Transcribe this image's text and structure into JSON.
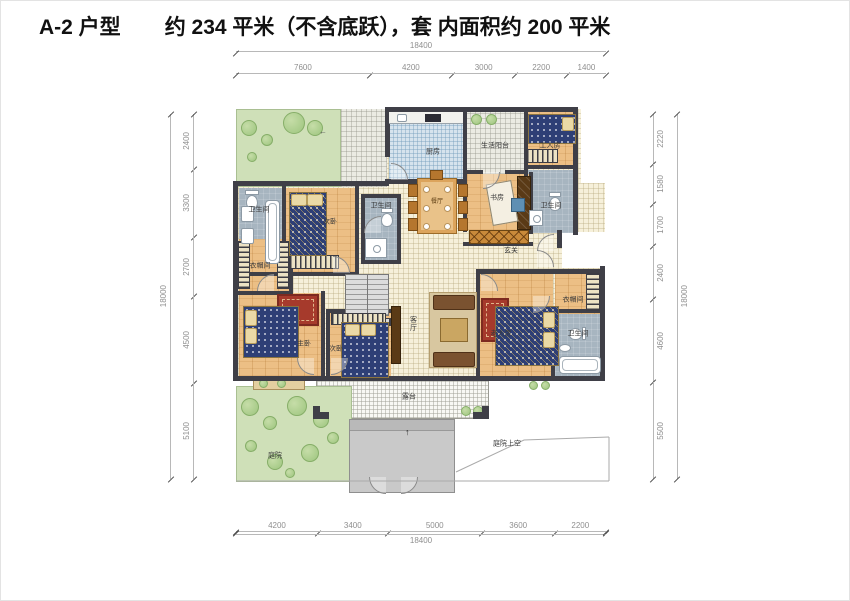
{
  "title": {
    "unit": "A-2 户型",
    "area": "约 234 平米（不含底跃），套 内面积约 200 平米"
  },
  "dimensions": {
    "top": {
      "total": "18400",
      "segments": [
        "7600",
        "4200",
        "3000",
        "2200",
        "1400"
      ]
    },
    "bottom": {
      "total": "18400",
      "segments": [
        "4200",
        "3400",
        "5000",
        "3600",
        "2200"
      ]
    },
    "left": {
      "total": "18000",
      "segments": [
        "2400",
        "3300",
        "2700",
        "4500",
        "5100"
      ]
    },
    "right": {
      "total": "18000",
      "segments": [
        "2220",
        "1580",
        "1700",
        "2400",
        "4600",
        "5500"
      ]
    }
  },
  "rooms": {
    "kitchen": "厨房",
    "living_balcony": "生活阳台",
    "maid_room": "工人房",
    "bath_top_right": "卫生间",
    "bath_left": "卫生间",
    "bath_middle": "卫生间",
    "bath_master": "卫生间",
    "bedroom_top": "次卧",
    "bedroom_bottom": "次卧",
    "master_bedroom": "主卧",
    "closet_left": "衣帽间",
    "closet_right": "衣帽间",
    "dining": "餐厅",
    "study": "书房",
    "foyer": "玄关",
    "living_room": "客厅",
    "elder_room": "老人房",
    "terrace": "露台",
    "courtyard": "庭院",
    "void_above": "庭院上空"
  },
  "arrows": {
    "entry": "↑",
    "path": "←"
  }
}
